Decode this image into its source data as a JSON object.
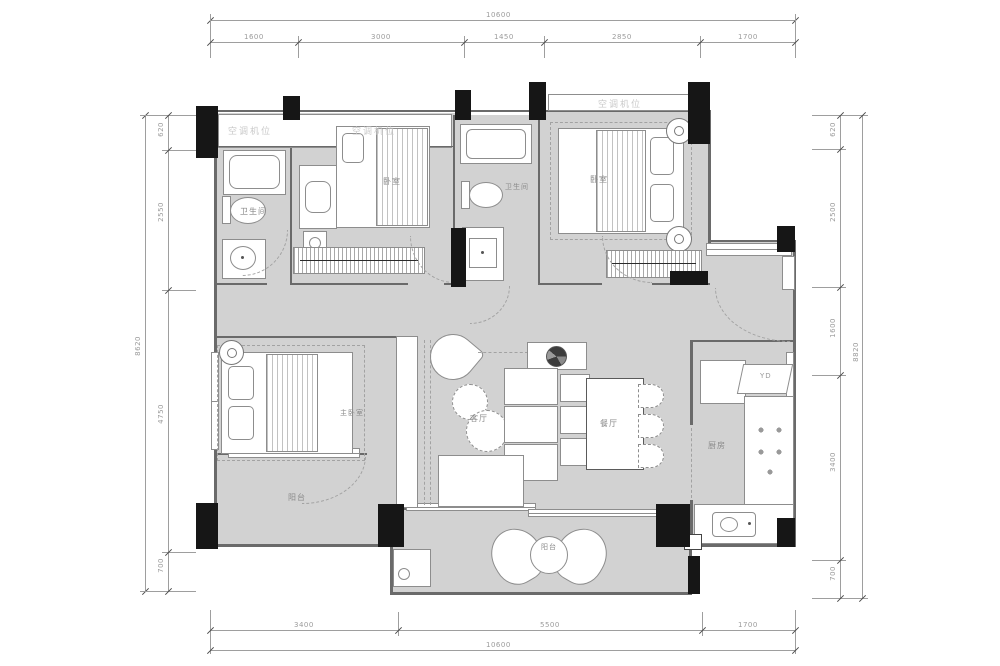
{
  "plan": {
    "type": "residential floor plan",
    "dimensions": {
      "top": {
        "total": "10600",
        "segments": [
          "1600",
          "3000",
          "1450",
          "2850",
          "1700"
        ]
      },
      "bottom": {
        "total": "10600",
        "segments": [
          "3400",
          "5500",
          "1700"
        ]
      },
      "left": {
        "total": "8620",
        "segments": [
          "620",
          "2550",
          "4750",
          "700"
        ]
      },
      "right": {
        "total": "8820",
        "segments": [
          "620",
          "2500",
          "1600",
          "3400",
          "700"
        ]
      }
    },
    "rooms": {
      "bathroom_top_left": "卫生间",
      "bedroom_top_middle": "卧室",
      "bathroom_middle": "卫生间",
      "bedroom_top_right": "卧室",
      "master_bedroom": "主卧室",
      "living_room": "客厅",
      "dining_room": "餐厅",
      "kitchen": "厨房",
      "balcony_west": "阳台",
      "balcony_south": "阳台"
    },
    "annotations": {
      "ac_platform": "空调机位",
      "flue": "YD"
    },
    "icons": {
      "ceiling_lamp": "double-ring circle symbol",
      "decor_plate": "round decorative plate on TV console"
    },
    "colors": {
      "floor": "#d2d2d2",
      "wall": "#161616",
      "furniture_line": "#8d8d8d",
      "dimension_text": "#9b9b9b",
      "label_text": "#8a8a8a"
    }
  }
}
